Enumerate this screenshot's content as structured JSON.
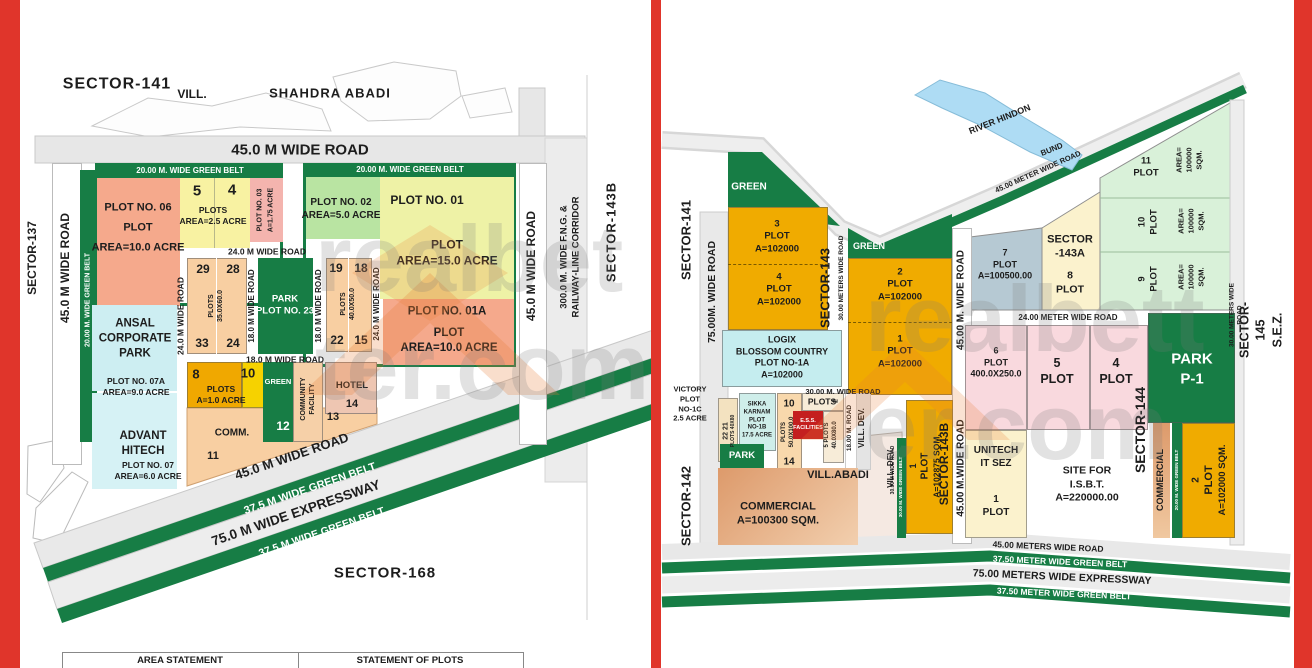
{
  "colors": {
    "frame_red": "#e0352b",
    "green_belt": "#177d45",
    "gold_plot": "#f0ab00",
    "water_blue": "#aedcf4",
    "ess_red": "#c41f1f",
    "commercial_orange": "#dd9a6b",
    "pink_plot": "#f9d9de",
    "salmon_plot": "#f5a98c"
  },
  "watermark": {
    "text": "realbetter.com"
  },
  "left": {
    "sector137": "SECTOR-137",
    "sector141": "SECTOR-141",
    "vill": "VILL.",
    "shahdra": "SHAHDRA ABADI",
    "road45_top": "45.0 M WIDE ROAD",
    "road45_left": "45.0 M WIDE ROAD",
    "belt20_left": "20.00 M. WIDE GREEN BELT",
    "belt20_b1": "20.00 M. WIDE GREEN BELT",
    "belt20_b2": "20.00 M. WIDE GREEN BELT",
    "plot06": "PLOT NO. 06\nPLOT\nAREA=10.0 ACRE",
    "n5": "5",
    "n4": "4",
    "plots25": "PLOTS\nAREA=2.5 ACRE",
    "plot03": "PLOT NO. 03",
    "plot03_a": "A=1.75 ACRE",
    "plot02": "PLOT NO. 02\nAREA=5.0 ACRE",
    "plot01": "PLOT NO. 01",
    "plot01_a": "PLOT\nAREA=15.0 ACRE",
    "plot01A": "PLOT NO. 01A",
    "plot01A_a": "PLOT\nAREA=10.0 ACRE",
    "road24_h": "24.0 M WIDE ROAD",
    "road24_vl": "24.0 M WIDE ROAD",
    "road24_vr": "24.0 M WIDE ROAD",
    "road18_vl": "18.0 M WIDE ROAD",
    "road18_vr": "18.0 M WIDE ROAD",
    "road18_h": "18.0 M WIDE ROAD",
    "n29": "29",
    "n28": "28",
    "n33": "33",
    "n24": "24",
    "plots3560": "PLOTS\n35.0X60.0",
    "park23": "PARK\nPLOT NO. 23",
    "n19": "19",
    "n18": "18",
    "n22": "22",
    "n15": "15",
    "plots4050": "PLOTS\n40.0X50.0",
    "ansal": "ANSAL\nCORPORATE\nPARK",
    "plot07A": "PLOT NO. 07A\nAREA=9.0 ACRE",
    "advant": "ADVANT\nHITECH",
    "plot07": "PLOT NO. 07\nAREA=6.0 ACRE",
    "n8": "8",
    "n10": "10",
    "plots10": "PLOTS\nA=1.0 ACRE",
    "green": "GREEN",
    "commfac": "COMMUNITY\nFACILITY",
    "hotel": "HOTEL",
    "n14": "14",
    "n13": "13",
    "n12": "12",
    "comm": "COMM.",
    "n11": "11",
    "road45_diag": "45.0 M WIDE ROAD",
    "belt375_1": "37.5 M WIDE GREEN BELT",
    "expwy75": "75.0 M WIDE EXPRESSWAY",
    "belt375_2": "37.5 M WIDE GREEN BELT",
    "sector168": "SECTOR-168",
    "road45_right": "45.0 M WIDE ROAD",
    "fng": "300.0 M. WIDE F.N.G. &\nRAILWAY-LINE CORRIDOR",
    "sector143b": "SECTOR-143B",
    "table_area": "AREA STATEMENT",
    "table_plots": "STATEMENT OF PLOTS"
  },
  "right": {
    "sector141": "SECTOR-141",
    "sector142": "SECTOR-142",
    "road75": "75.00M. WIDE ROAD",
    "green1": "GREEN",
    "p3": "3\nPLOT\nA=102000",
    "p4": "4\nPLOT\nA=102000",
    "sector143": "SECTOR-143",
    "road30_v": "30.00 METERS WIDE ROAD",
    "green2": "GREEN",
    "p2": "2\nPLOT\nA=102000",
    "p1": "1\nPLOT\nA=102000",
    "road30_h": "30.00 M. WIDE ROAD",
    "road45_v1": "45.00 M. WIDE ROAD",
    "road45_v2": "45.00 M.WIDE ROAD",
    "p7": "7\nPLOT\nA=100500.00",
    "sec143A": "SECTOR\n-143A",
    "p8": "8\nPLOT",
    "p11": "11\nPLOT",
    "p10": "10\nPLOT",
    "p9": "9\nPLOT",
    "a100k": "AREA=\n100000\nSQM.",
    "river": "RIVER HINDON",
    "bund": "BUND",
    "road45_diag": "45.00 METER WIDE ROAD",
    "belt_diag": "GREEN BELT",
    "road24": "24.00 METER WIDE ROAD",
    "p6": "6\nPLOT\n400.0X250.0",
    "p5": "5\nPLOT",
    "p4b": "4\nPLOT",
    "sector144": "SECTOR-144",
    "parkP1": "PARK\nP-1",
    "commercial_v": "COMMERCIAL",
    "belt20_v": "20.00 M. WIDE GREEN BELT",
    "p2b_n": "2",
    "p2b_plot": "PLOT",
    "p2b_a": "A=102000 SQM.",
    "unitech": "UNITECH\nIT SEZ",
    "u1": "1\nPLOT",
    "isbt": "SITE FOR\nI.S.B.T.\nA=220000.00",
    "road30_v2": "30.00 METERS WIDE ROAD",
    "sector145": "SECTOR-145\nS.E.Z.",
    "logix": "LOGIX\nBLOSSOM COUNTRY\nPLOT NO-1A\nA=102000",
    "victory": "VICTORY\nPLOT\nNO-1C\n2.5 ACRE",
    "n2221": "22 21",
    "plots4080s": "PLOTS 40X80",
    "sikka": "SIKKA\nKARNAM\nPLOT\nNO-1B\n17.5 ACRE",
    "n10": "10",
    "n14": "14",
    "plots50100": "PLOTS\n50.0X100.0",
    "plots_lbl": "PLOTS",
    "plots4080": "5 PLOTS\n40.0X80.0",
    "n2": "2",
    "ess": "E.S.S.\nFACILITIES",
    "road18": "18.00 M. ROAD",
    "villdev": "VILL. DEV.",
    "villabadi": "VILL.ABADI",
    "park_sm": "PARK",
    "commercial": "COMMERCIAL\nA=100300 SQM.",
    "p1v_n": "1",
    "p1v_plot": "PLOT",
    "p1v_a": "A=102875 SQM.",
    "sector143b_big": "SECTOR-143B",
    "belt30_v": "30.00 M. WIDE GREEN BELT",
    "road30_tiny": "30.00 M WIDE ROAD",
    "band_road45": "45.00 METERS WIDE ROAD",
    "band_belt1": "37.50 METER WIDE GREEN BELT",
    "band_expwy": "75.00 METERS WIDE EXPRESSWAY",
    "band_belt2": "37.50 METER WIDE GREEN BELT"
  }
}
